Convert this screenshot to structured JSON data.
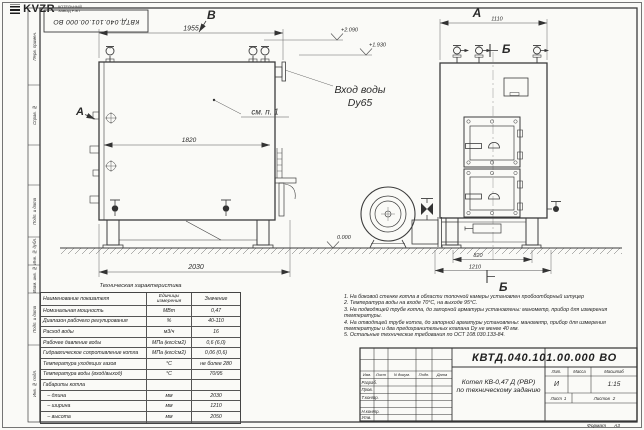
{
  "sheet": {
    "stamp_top_left": "КВТД.040.101.00.000 ВО",
    "format_label": "Формат",
    "format_value": "А3",
    "frame_labels": [
      "Перв. примен.",
      "Справ. №",
      "Подп. и дата",
      "Инв. № дубл.",
      "Взам. инв. №",
      "Подп. и дата",
      "Инв. № подл."
    ]
  },
  "drawing": {
    "view_labels": {
      "top_b": "В",
      "left_a": "А",
      "front_a": "А",
      "section_top": "Б",
      "section_bottom": "Б"
    },
    "dimensions": {
      "side_width_top": "1955",
      "side_width_inner": "1820",
      "side_width_bottom": "2030",
      "front_width": "1110",
      "front_base_inner": "820",
      "front_base_outer": "1210"
    },
    "elevations": {
      "upper": "+2.090",
      "lower": "+1.930",
      "ground": "0.000"
    },
    "inlet": {
      "line1": "Вход воды",
      "line2": "Dy65"
    },
    "callout_note": "см. п. 1"
  },
  "spec_table": {
    "title": "Техническая характеристика",
    "col_name": "Наименование показателя",
    "col_unit_line1": "Единицы",
    "col_unit_line2": "измерения",
    "col_value": "Значение",
    "rows": [
      {
        "name": "Номинальная мощность",
        "unit": "МВт",
        "value": "0,47"
      },
      {
        "name": "Диапазон рабочего регулирования",
        "unit": "%",
        "value": "40-110"
      },
      {
        "name": "Расход воды",
        "unit": "м3/ч",
        "value": "16"
      },
      {
        "name": "Рабочее давление воды",
        "unit": "МПа (кгс/см2)",
        "value": "0,6 (6,0)"
      },
      {
        "name": "Гидравлическое сопротивление котла",
        "unit": "МПа (кгс/см2)",
        "value": "0,06 (0,6)"
      },
      {
        "name": "Температура уходящих газов",
        "unit": "°С",
        "value": "не более 280"
      },
      {
        "name": "Температура воды (вход/выход)",
        "unit": "°С",
        "value": "70/95"
      },
      {
        "name": "Габариты котла",
        "unit": "",
        "value": ""
      },
      {
        "name": "   – длина",
        "unit": "мм",
        "value": "2030"
      },
      {
        "name": "   – ширина",
        "unit": "мм",
        "value": "1210"
      },
      {
        "name": "   – высота",
        "unit": "мм",
        "value": "2050"
      }
    ]
  },
  "notes": [
    "1. На боковой стенке котла в области топочной камеры установлен пробоотборный штуцер",
    "2. Температура воды на входе 70°С, на выходе 95°С.",
    "3. На подводящей трубе котла, до запорной арматуры установлены: манометр, прибор для измерения температуры.",
    "4. На отводящей трубе котла, до запорной арматуры установлены: манометр, прибор для измерения температуры и два предохранительных клапана Dy не менее 40 мм.",
    "5. Остальные технические требования по ОСТ 108.030.133-84."
  ],
  "title_block": {
    "doc_number": "КВТД.040.101.00.000  ВО",
    "title_line1": "Котел  КВ-0,47 Д  (РВР)",
    "title_line2": "по техническому заданию",
    "cols": [
      "Изм.",
      "Лист",
      "N докум.",
      "Подп.",
      "Дата"
    ],
    "rows": [
      "Разраб.",
      "Пров.",
      "Т.контр.",
      "Н.контр.",
      "Утв."
    ],
    "lit_label": "Лит.",
    "lit_value": "И",
    "mass_label": "Масса",
    "scale_label": "Масштаб",
    "scale_value": "1:15",
    "sheet_label": "Лист",
    "sheet_num": "1",
    "sheets_label": "Листов",
    "sheets_num": "2",
    "logo_text": "KVZR",
    "company_line1": "КОТЕЛЬНЫЙ",
    "company_line2": "ЗАВОД РЭП"
  }
}
